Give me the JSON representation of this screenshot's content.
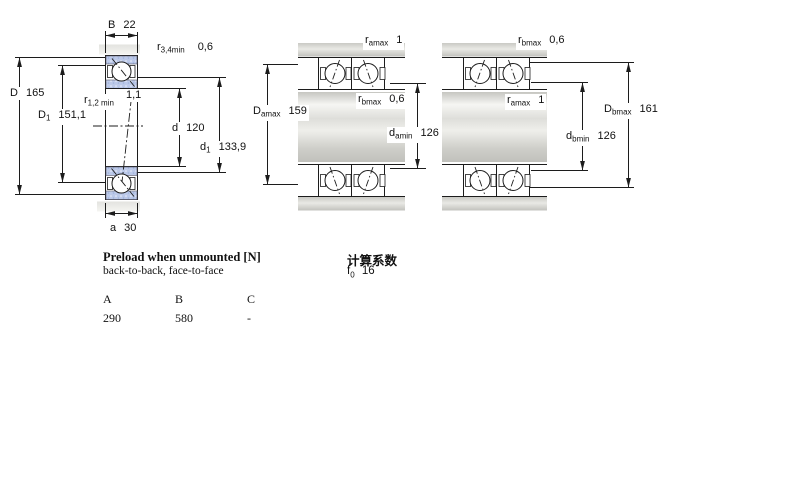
{
  "drawing": {
    "left": {
      "B": {
        "base": "B",
        "value": "22"
      },
      "r34": {
        "base": "r",
        "sub": "3,4min",
        "value": "0,6"
      },
      "D": {
        "base": "D",
        "value": "165"
      },
      "D1": {
        "base": "D",
        "sub": "1",
        "value": "151,1"
      },
      "r12": {
        "base": "r",
        "sub": "1,2 min",
        "value": "1,1"
      },
      "d": {
        "base": "d",
        "value": "120"
      },
      "d1": {
        "base": "d",
        "sub": "1",
        "value": "133,9"
      },
      "a": {
        "base": "a",
        "value": "30"
      }
    },
    "middle": {
      "ramax": {
        "base": "r",
        "sub": "amax",
        "value": "1"
      },
      "rbmax": {
        "base": "r",
        "sub": "bmax",
        "value": "0,6"
      },
      "Damax": {
        "base": "D",
        "sub": "amax",
        "value": "159"
      },
      "damin": {
        "base": "d",
        "sub": "amin",
        "value": "126"
      }
    },
    "right": {
      "rbmax": {
        "base": "r",
        "sub": "bmax",
        "value": "0,6"
      },
      "ramax": {
        "base": "r",
        "sub": "amax",
        "value": "1"
      },
      "Dbmax": {
        "base": "D",
        "sub": "bmax",
        "value": "161"
      },
      "dbmin": {
        "base": "d",
        "sub": "bmin",
        "value": "126"
      }
    }
  },
  "preload": {
    "title": "Preload when unmounted [N]",
    "subtitle": "back-to-back, face-to-face",
    "columns": [
      "A",
      "B",
      "C"
    ],
    "values": [
      "290",
      "580",
      "-"
    ]
  },
  "calculation": {
    "title": "计算系数",
    "f0": {
      "base": "f",
      "sub": "0",
      "value": "16"
    }
  },
  "colors": {
    "line": "#1c1c1c",
    "ring_blue": "#bcc9e9",
    "steel_gray": "#cdcdc8"
  }
}
